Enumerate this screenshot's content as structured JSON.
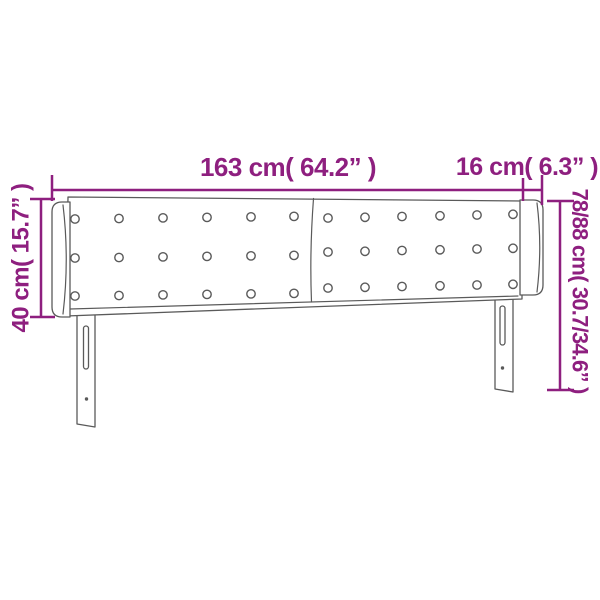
{
  "diagram": {
    "type": "product-dimension-diagram",
    "subject": "upholstered headboard with side ears, tufted buttons and two slotted legs",
    "colors": {
      "accent": "#8E1F7F",
      "outline": "#5A5A5A",
      "background": "#FFFFFF"
    },
    "labels": {
      "total_width": "163 cm( 64.2” )",
      "ear_width": "16 cm( 6.3” )",
      "side_height": "40 cm( 15.7” )",
      "total_height": "78/88 cm( 30.7/34.6” )"
    },
    "headboard": {
      "panel_count": 2,
      "button_columns_per_panel": 6,
      "button_rows": 3,
      "leg_count": 2
    }
  }
}
